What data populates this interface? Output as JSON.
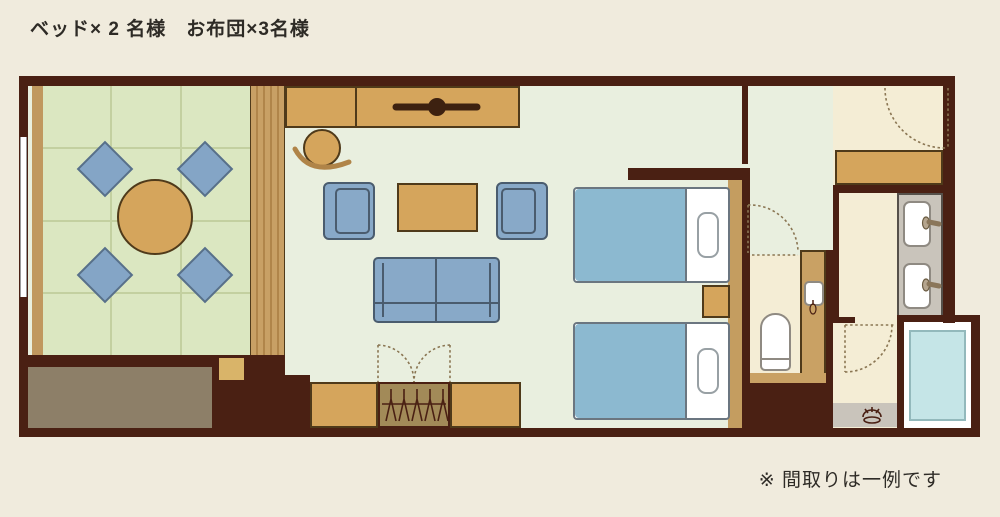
{
  "header": {
    "capacity_label": "ベッド× 2 名様　お布団×3名様"
  },
  "footnote": {
    "note": "※ 間取りは一例です"
  },
  "colors": {
    "page_bg": "#f0ebdd",
    "text": "#2e2b26",
    "wall": "#4a2013",
    "outline": "#4f3a1a",
    "floor_green": "#e9efdf",
    "tatami": "#dbe7c1",
    "tatami_line": "#c3d0a0",
    "tatami_edge": "#c0985f",
    "cream": "#f4edd5",
    "tan": "#d5a55c",
    "tan_light": "#d9b469",
    "tan_mid": "#c9a164",
    "headboard": "#c49d60",
    "closet_in": "#a28a58",
    "hanger": "#4a2013",
    "wood1": "#c8a065",
    "wood2": "#b0854a",
    "taupe": "#8d7f68",
    "blue": "#88a9c8",
    "blue_border": "#4a5c6e",
    "bed_blue": "#8cb9d0",
    "bed_border": "#6b7680",
    "pillow_border": "#98a0a4",
    "cushion": "#84a5c6",
    "cushion_border": "#587089",
    "tub_blue": "#c5e5e7",
    "tub_border": "#93b9bc",
    "counter": "#c9c4bb",
    "fixture_border": "#8f8a82",
    "dotted": "#8a7653",
    "tv": "#3d2110",
    "stool_arc": "#b08448",
    "window": "#ffffff"
  }
}
